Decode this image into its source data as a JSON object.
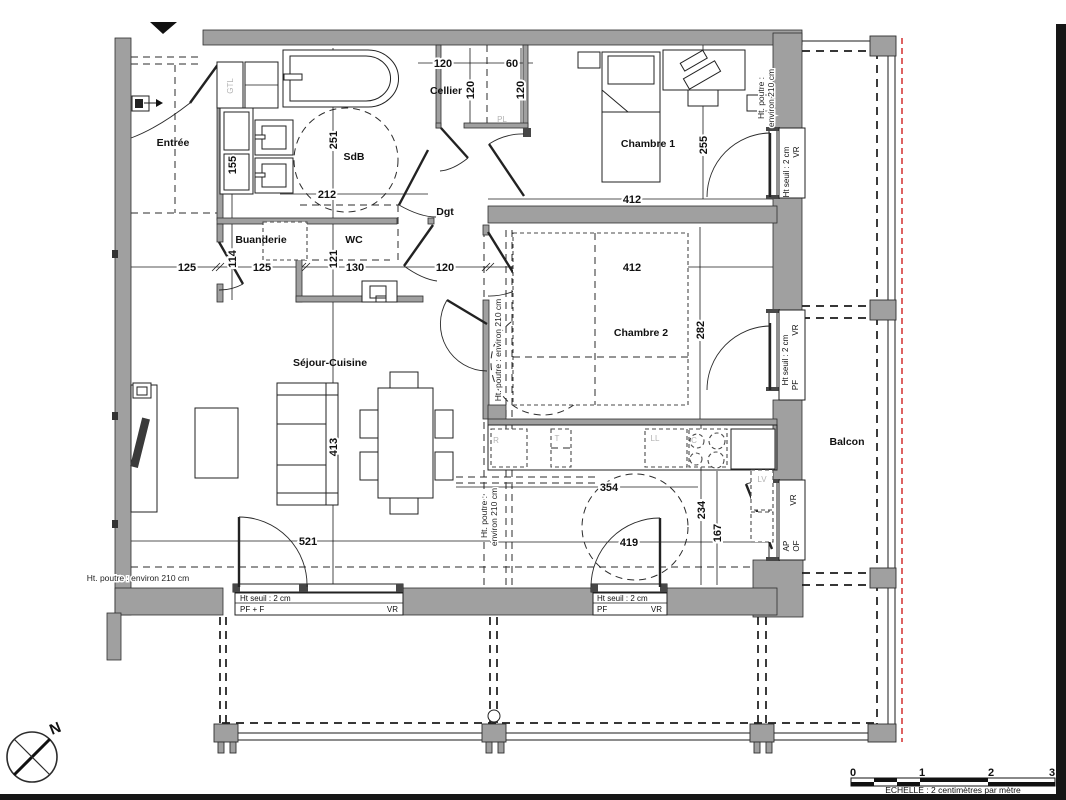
{
  "rooms": {
    "entree": "Entrée",
    "sdb": "SdB",
    "cellier": "Cellier",
    "chambre1": "Chambre 1",
    "buanderie": "Buanderie",
    "wc": "WC",
    "dgt": "Dgt",
    "chambre2": "Chambre 2",
    "sejour_cuisine": "Séjour-Cuisine",
    "balcon": "Balcon"
  },
  "dimensions": {
    "cellier_top": "120",
    "cellier_60": "60",
    "cellier_v1": "120",
    "cellier_v2": "120",
    "ch1_width": "412",
    "ch1_depth": "255",
    "sdb_width": "212",
    "sdb_depth": "251",
    "entree_placard": "155",
    "row_125a": "125",
    "buanderie_114": "114",
    "row_125b": "125",
    "wc_121": "121",
    "row_130": "130",
    "row_120": "120",
    "ch2_width": "412",
    "ch2_depth": "282",
    "sejour_depth": "413",
    "sejour_width": "521",
    "cuisine_354": "354",
    "cuisine_419": "419",
    "cuisine_234": "234",
    "cuisine_167": "167"
  },
  "annotations": {
    "beam_height": "Ht. poutre : environ 210 cm",
    "beam_line1": "Ht. poutre :",
    "beam_line2": "environ 210 cm"
  },
  "window_labels": {
    "sill": "Ht seuil : 2 cm",
    "vr": "VR",
    "pf": "PF",
    "pf_f": "PF + F",
    "ap": "AP",
    "of": "OF"
  },
  "equipment": {
    "gtl": "GTL",
    "pl": "PL",
    "fridge_r": "R",
    "t": "T",
    "ll": "LL",
    "cooktop_c": "C",
    "lv": "LV"
  },
  "compass": {
    "north": "N"
  },
  "scale_bar": {
    "tick0": "0",
    "tick1": "1",
    "tick2": "2",
    "tick3": "3",
    "caption": "ECHELLE : 2 centimètres par mètre"
  }
}
